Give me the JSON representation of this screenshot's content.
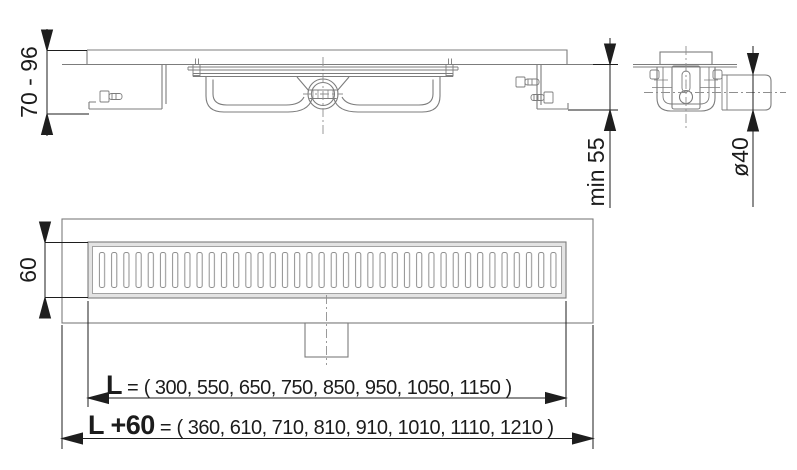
{
  "drawing": {
    "colors": {
      "background": "#ffffff",
      "drawing_line": "#7c7c7c",
      "light_line": "#9a9a9a",
      "dimension": "#1e1e1e",
      "grate_frame_fill": "#e3e3e3"
    },
    "dimensions": {
      "height_range": "70 - 96",
      "min_depth": "min 55",
      "pipe_diameter": "ø40",
      "grate_width": "60",
      "length": {
        "label": "L",
        "equals": "=",
        "values": "( 300, 550, 650, 750, 850, 950, 1050, 1150 )"
      },
      "overall_length": {
        "label": "L +60",
        "equals": "=",
        "values": "( 360, 610, 710, 810, 910, 1010, 1110, 1210 )"
      },
      "length_options": [
        300,
        550,
        650,
        750,
        850,
        950,
        1050,
        1150
      ],
      "overall_length_options": [
        360,
        610,
        710,
        810,
        910,
        1010,
        1110,
        1210
      ]
    }
  }
}
